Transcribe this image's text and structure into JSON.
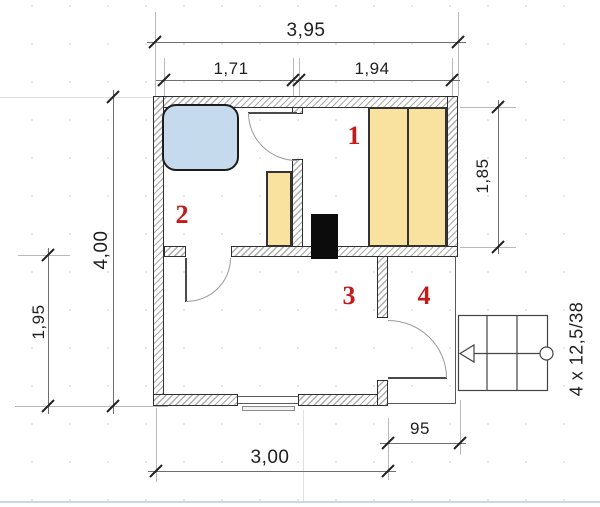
{
  "plan": {
    "title": "sauna-floor-plan",
    "dimensions": {
      "overall_width": "3,95",
      "room2_width": "1,71",
      "room1_width": "1,94",
      "overall_height": "4,00",
      "room3_height": "1,95",
      "room1_height": "1,85",
      "bottom_width": "3,00",
      "porch_width": "95",
      "stairs_label": "4 x 12,5/38"
    },
    "rooms": [
      {
        "number": "1"
      },
      {
        "number": "2"
      },
      {
        "number": "3"
      },
      {
        "number": "4"
      }
    ],
    "colors": {
      "room_label_red": "#c41a1a",
      "tub_blue": "#c6daed",
      "bench_yellow": "#f9e2a0",
      "stove_black": "#0c0c0c",
      "wall_hatch_gray": "#adadad",
      "baseline_blue_gray": "#ccd8e0"
    }
  }
}
